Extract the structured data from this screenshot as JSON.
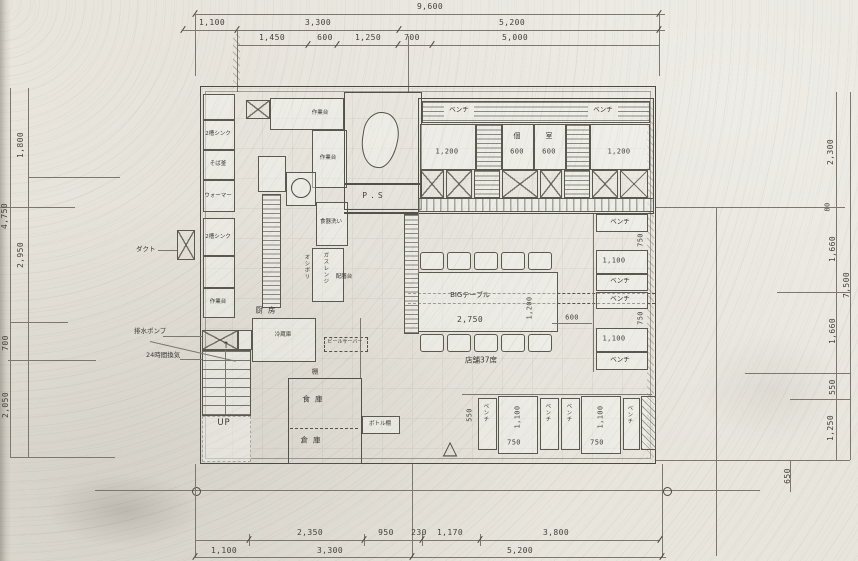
{
  "dims": {
    "top_total": "9,600",
    "top_row2": [
      "1,100",
      "3,300",
      "5,200"
    ],
    "top_row3": [
      "1,450",
      "600",
      "1,250",
      "700",
      "5,000"
    ],
    "left": {
      "d1800": "1,800",
      "d4750": "4,750",
      "d2950": "2,950",
      "d700": "700",
      "d2050": "2,050"
    },
    "right": {
      "d2300": "2,300",
      "d80": "80",
      "d1660a": "1,660",
      "d7500": "7,500",
      "d1660b": "1,660",
      "d550": "550",
      "d1250": "1,250",
      "d650": "650"
    },
    "bottom_row1": [
      "2,350",
      "950",
      "230",
      "1,170",
      "3,800"
    ],
    "bottom_row2": [
      "1,100",
      "3,300",
      "5,200"
    ]
  },
  "kitchen": {
    "room": "厨房",
    "eq_sink2a": "2槽シンク",
    "eq_sobagama": "そば釜",
    "eq_warmer": "ウォーマー",
    "eq_sink2b": "2槽シンク",
    "eq_worktable": "作業台",
    "eq_dishwash": "食器洗い",
    "eq_gasrange": "ガスレンジ",
    "eq_fridge": "冷蔵庫",
    "beer_server": "ビールサーバー",
    "oshibori": "オシボリ",
    "serving_counter": "配膳台",
    "duct": "ダクト",
    "pipe_space": "P.S",
    "shelf": "棚"
  },
  "rooms": {
    "pantry": "食庫",
    "storage": "倉庫",
    "bottle_shelf": "ボトル棚"
  },
  "stairs": {
    "up": "UP",
    "pump": "排水ポンプ",
    "vent": "24時間換気"
  },
  "seating": {
    "bench": "ベンチ",
    "private_left": "個",
    "private_right": "室",
    "big_table": "BIGテーブル",
    "capacity": "店舗37席",
    "w1200": "1,200",
    "w600": "600",
    "l2750": "2,750",
    "w1100": "1,100",
    "w750": "750",
    "w550": "550"
  },
  "icons": {
    "entrance_arrow": "△",
    "up_arrow": "↑"
  }
}
